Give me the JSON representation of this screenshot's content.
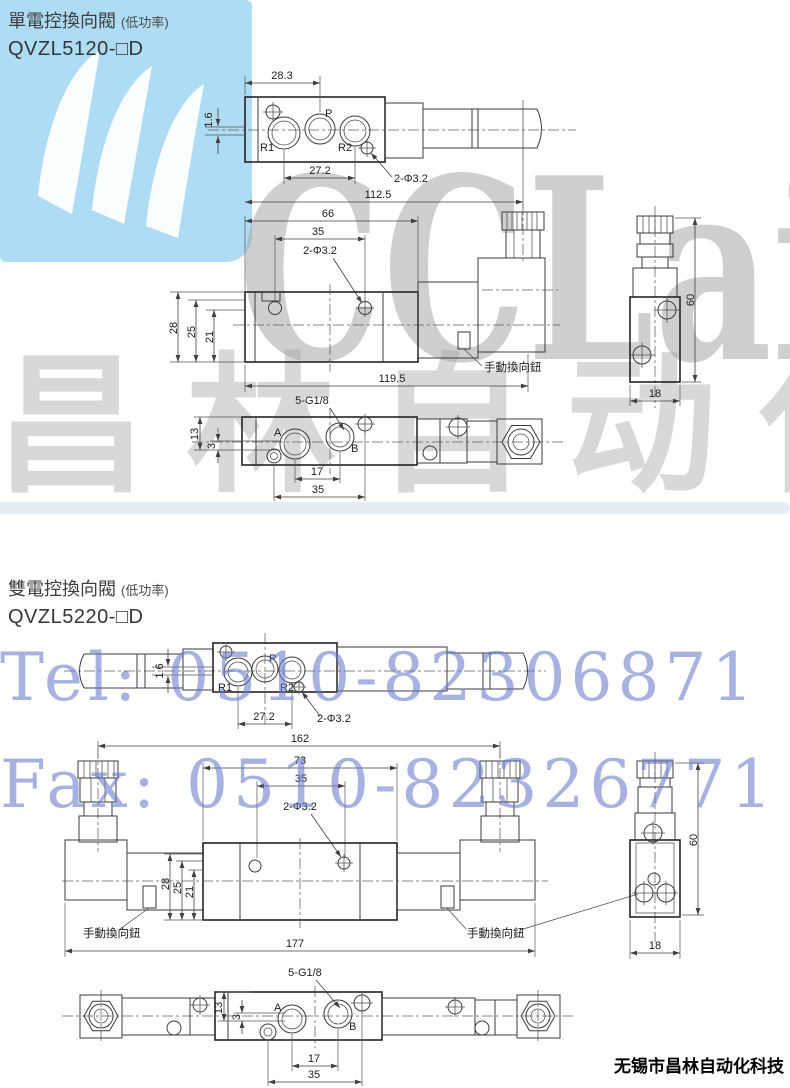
{
  "watermarks": {
    "logo_text": "CCLair",
    "brand_text": "昌林自动化",
    "tel": "Tel: 0510-82306871",
    "fax": "Fax: 0510-82326771"
  },
  "footer": {
    "company": "无锡市昌林自动化科技"
  },
  "s1": {
    "title": "單電控換向閥",
    "title_note": "(低功率)",
    "model": "QVZL5120-□D",
    "top": {
      "w": "28.3",
      "offset": "1.6",
      "r1": "R1",
      "p": "P",
      "r2": "R2",
      "pitch": "27.2",
      "holes": "2-Φ3.2"
    },
    "front": {
      "l1": "112.5",
      "l2": "66",
      "l3": "35",
      "holes": "2-Φ3.2",
      "h1": "28",
      "h2": "25",
      "h3": "21",
      "len": "119.5",
      "manual": "手動換向鈕"
    },
    "side": {
      "h": "60",
      "w": "18"
    },
    "bottom": {
      "thread": "5-G1/8",
      "h1": "13",
      "h2": "3",
      "a": "A",
      "b": "B",
      "p1": "17",
      "p2": "35"
    }
  },
  "s2": {
    "title": "雙電控換向閥",
    "title_note": "(低功率)",
    "model": "QVZL5220-□D",
    "top": {
      "offset": "1.6",
      "r1": "R1",
      "p": "P",
      "r2": "R2",
      "pitch": "27.2",
      "holes": "2-Φ3.2"
    },
    "front": {
      "l1": "162",
      "l2": "73",
      "l3": "35",
      "holes": "2-Φ3.2",
      "h1": "28",
      "h2": "25",
      "h3": "21",
      "len": "177",
      "manual_left": "手動換向鈕",
      "manual_right": "手動換向鈕"
    },
    "side": {
      "h": "60",
      "w": "18"
    },
    "bottom": {
      "thread": "5-G1/8",
      "h1": "13",
      "h2": "3",
      "a": "A",
      "b": "B",
      "p1": "17",
      "p2": "35"
    }
  }
}
